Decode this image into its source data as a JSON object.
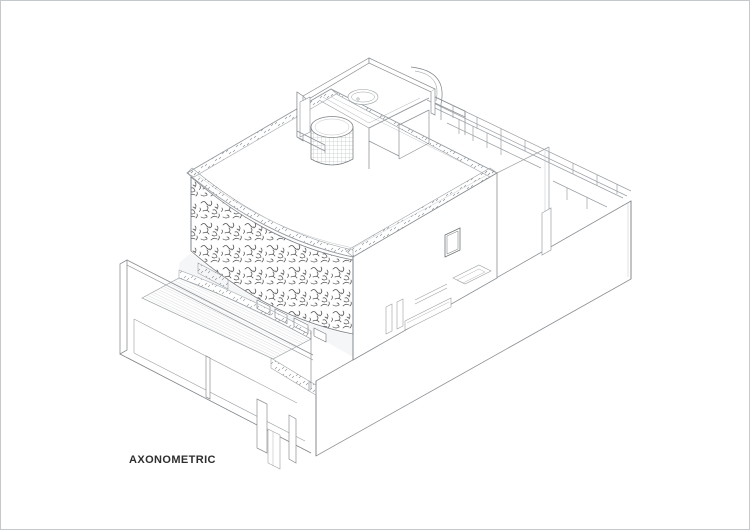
{
  "page": {
    "background": "#ffffff",
    "border_color": "#c6c9cc"
  },
  "drawing": {
    "caption": "AXONOMETRIC",
    "caption_color": "#2e2e2e",
    "line_color": "#9aa0a5",
    "dark_line_color": "#7e8388",
    "hatch_color": "#4d4d4d",
    "stipple_color": "#8d9296",
    "deck_hatch_color": "#bfc3c7",
    "shadow_fill": "#f1f2f3",
    "parts": [
      "base-volume",
      "rear-wing-railing",
      "rear-court",
      "roof-terrace",
      "parapet-stipple-bands",
      "curved-screen-wall",
      "clerestory-windows",
      "facade-window",
      "strip-windows",
      "rooflight-opening",
      "rooftop-pavilion",
      "stair-cylinder",
      "bath-tub",
      "pool-deck",
      "deck-parapet",
      "left-parapet-wall",
      "ground-recess",
      "pilotis-columns",
      "stair-block"
    ]
  }
}
